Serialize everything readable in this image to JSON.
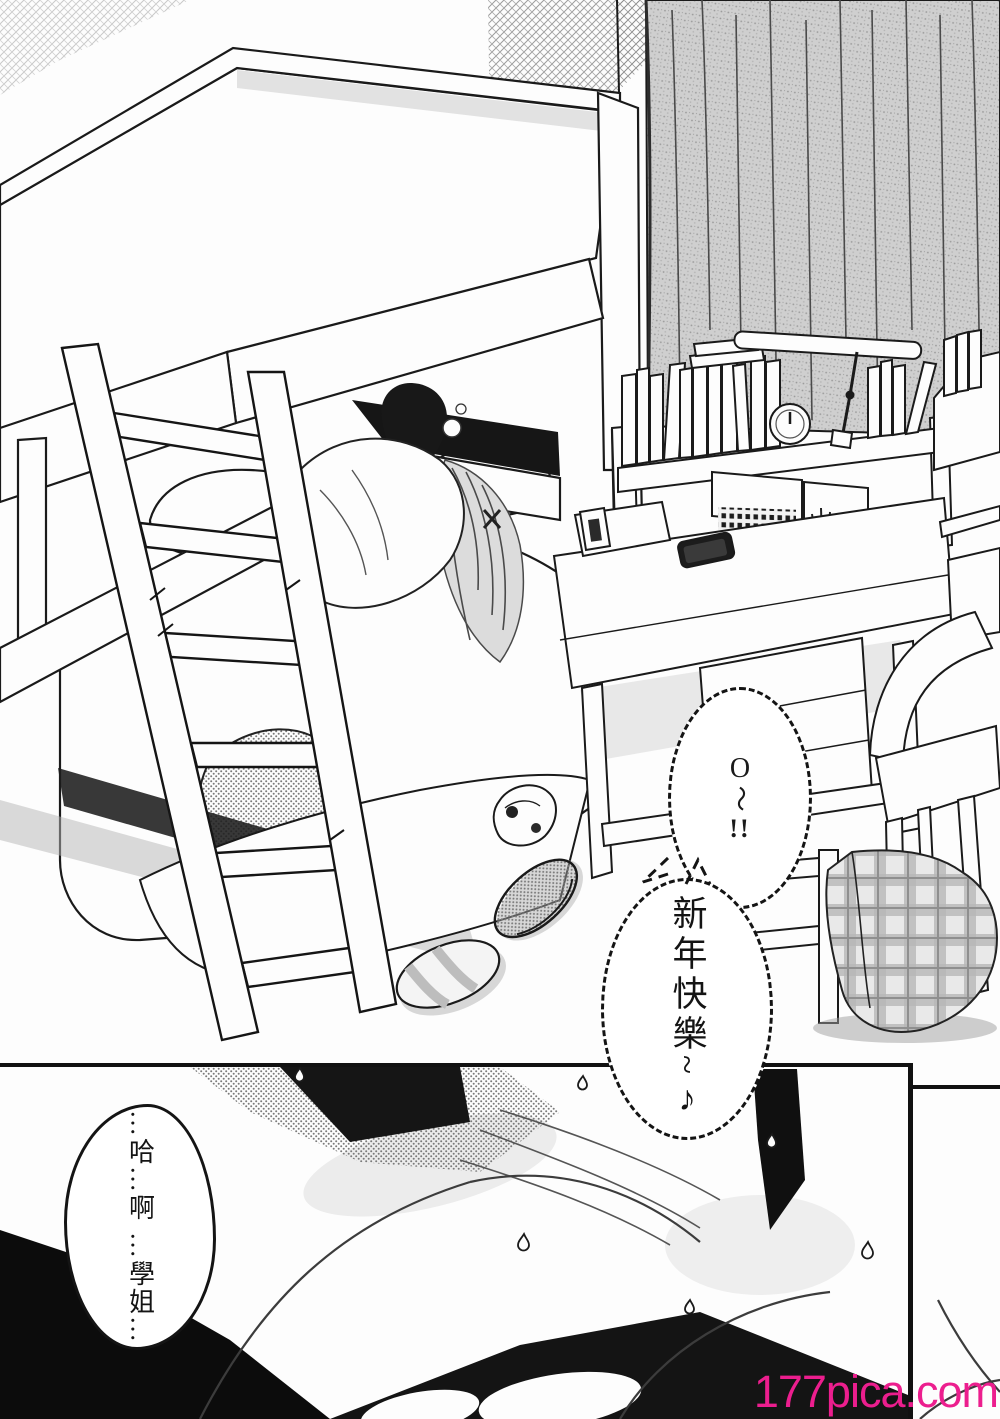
{
  "bubbles": {
    "exclaim": {
      "char_top": "O",
      "char_mid": "〜",
      "char_bottom": "!!"
    },
    "new_year": {
      "text": "新年快樂~♪"
    },
    "moan": {
      "col_right": "…哈…啊",
      "col_left": "…學姐…"
    }
  },
  "watermark": {
    "text": "177pica.com",
    "color": "#EC1E8E"
  },
  "ink_color": "#1a1a1a"
}
